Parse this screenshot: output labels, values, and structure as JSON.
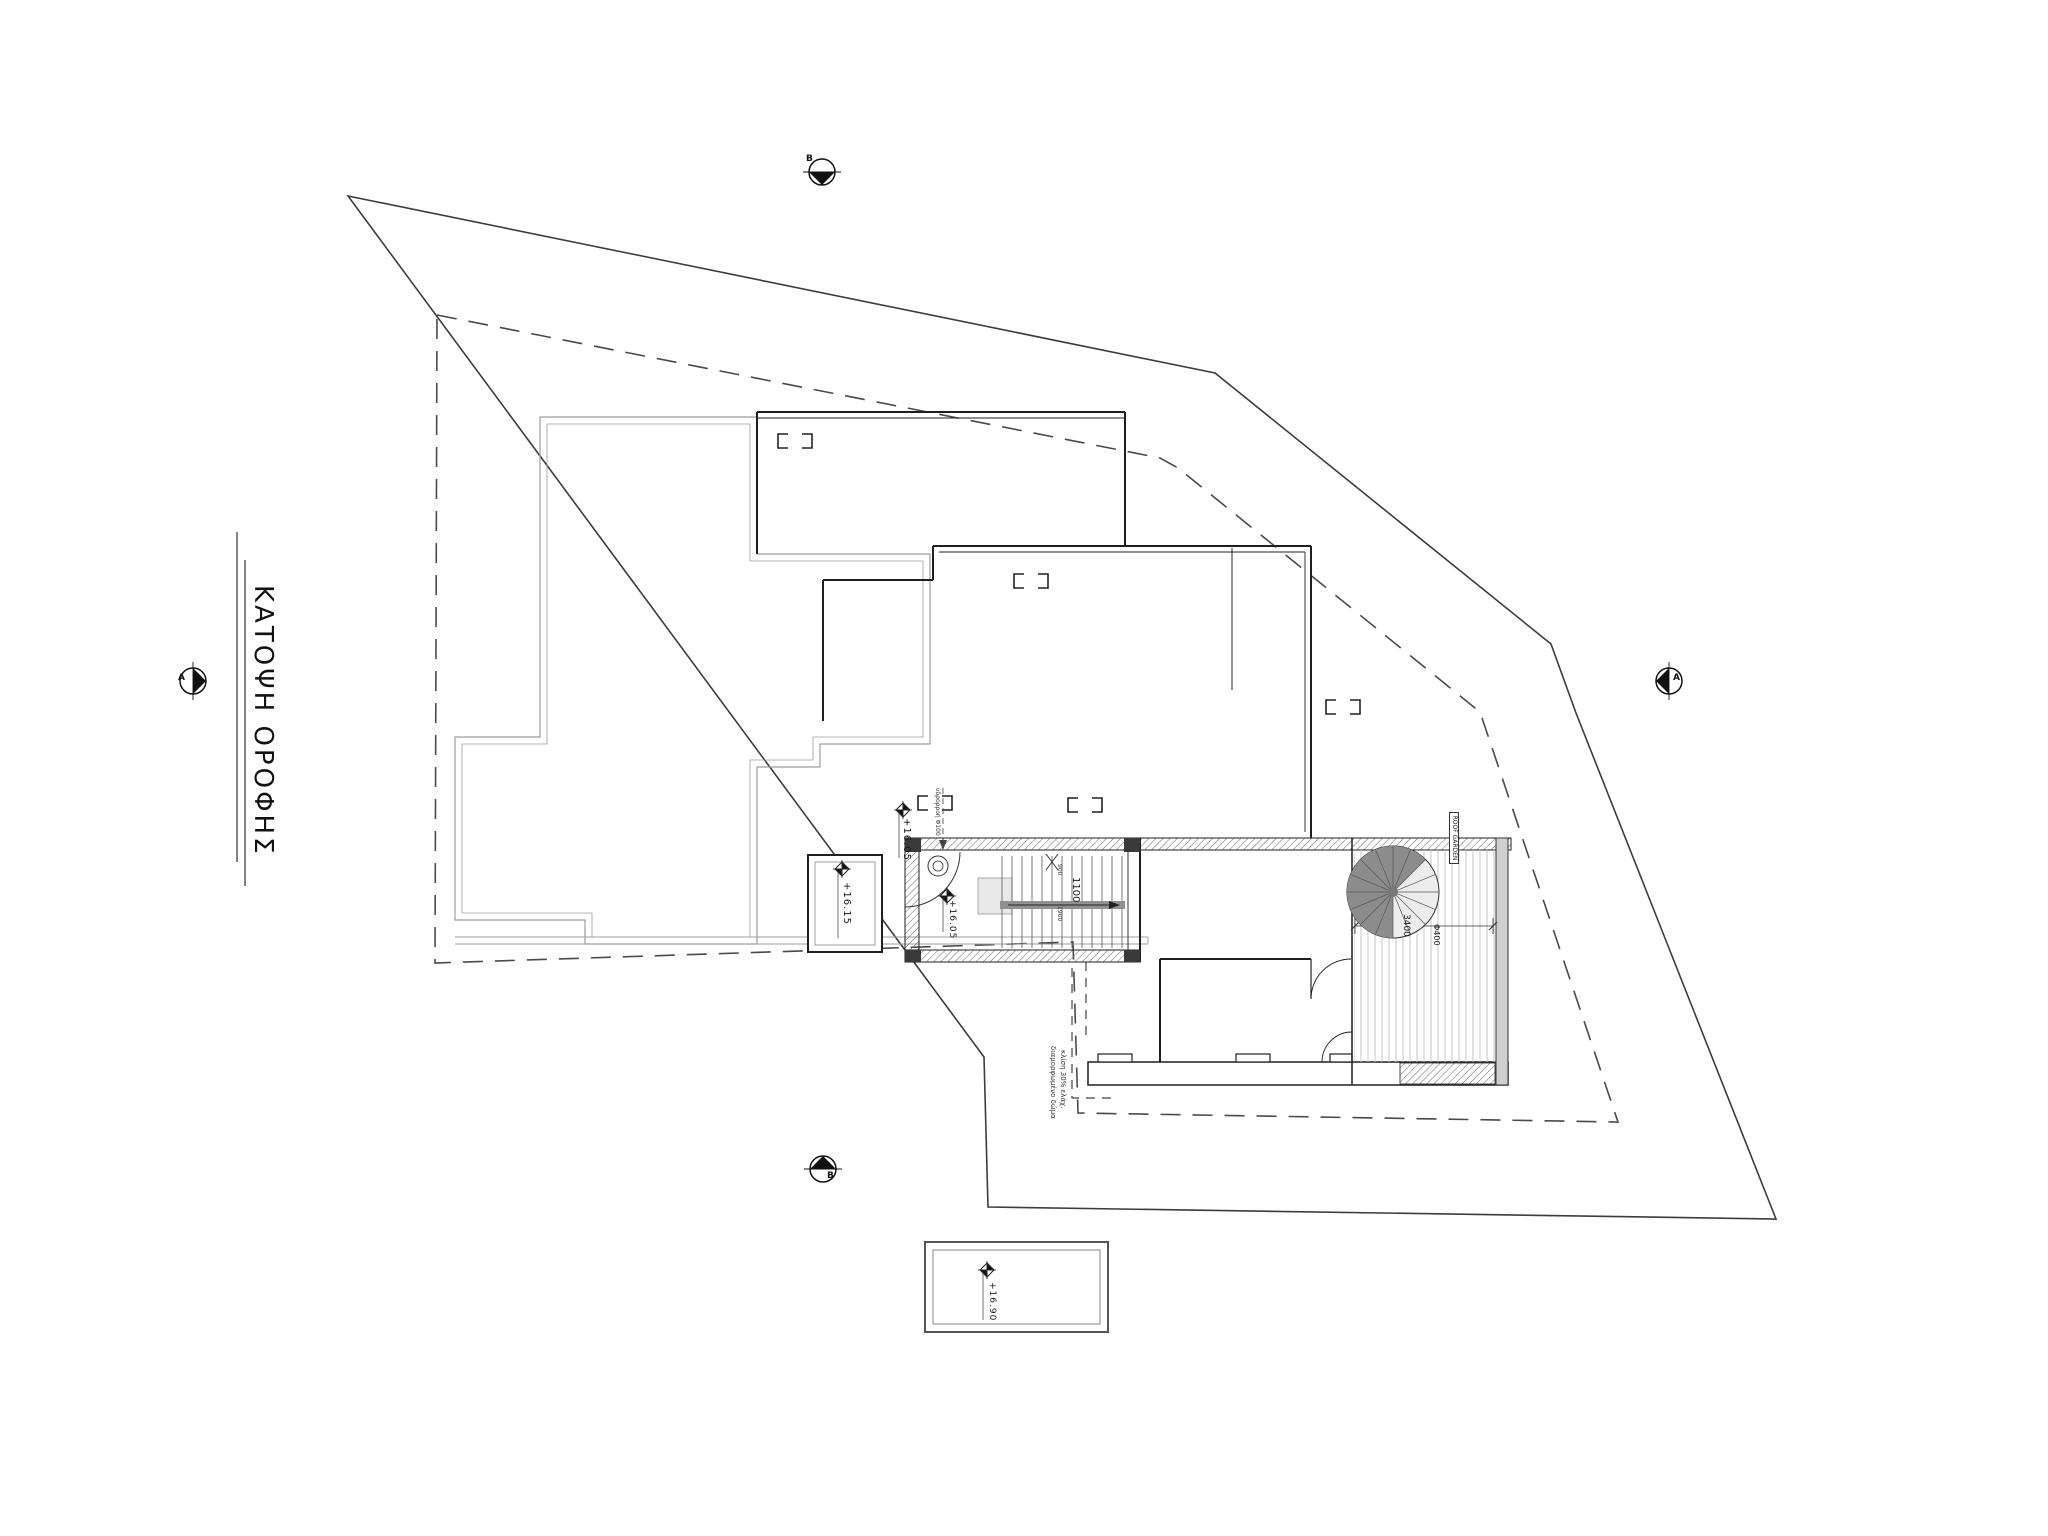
{
  "title": {
    "text": "ΚΑΤΟΨΗ ΟΡΟΦΗΣ"
  },
  "levels": {
    "stair_landing_out": "+16.05",
    "stair_inside": "+16.05",
    "west_box": "+16.15",
    "pool": "+16.90"
  },
  "dimensions": {
    "stair_width": "1100",
    "deck_span": "3400",
    "spiral": "Φ400",
    "rise_upper": "900",
    "rise_lower": "1900"
  },
  "annotations": {
    "deck_box": "ROOF GARDEN",
    "drain": "υδρορροή Φ100",
    "roof_note_line1": "διαμορφωμένο δώμα",
    "roof_note_line2": "κλίση 30% ελάχ."
  },
  "section_markers": {
    "top": "Β",
    "bottom": "Β",
    "left": "Α",
    "right": "Α"
  },
  "colors": {
    "boundary_line": "#3c3c3c",
    "roof_outline": "#9c9c9c",
    "wall": "#1f1f1f",
    "deck_stripe": "#c4c4c4"
  }
}
